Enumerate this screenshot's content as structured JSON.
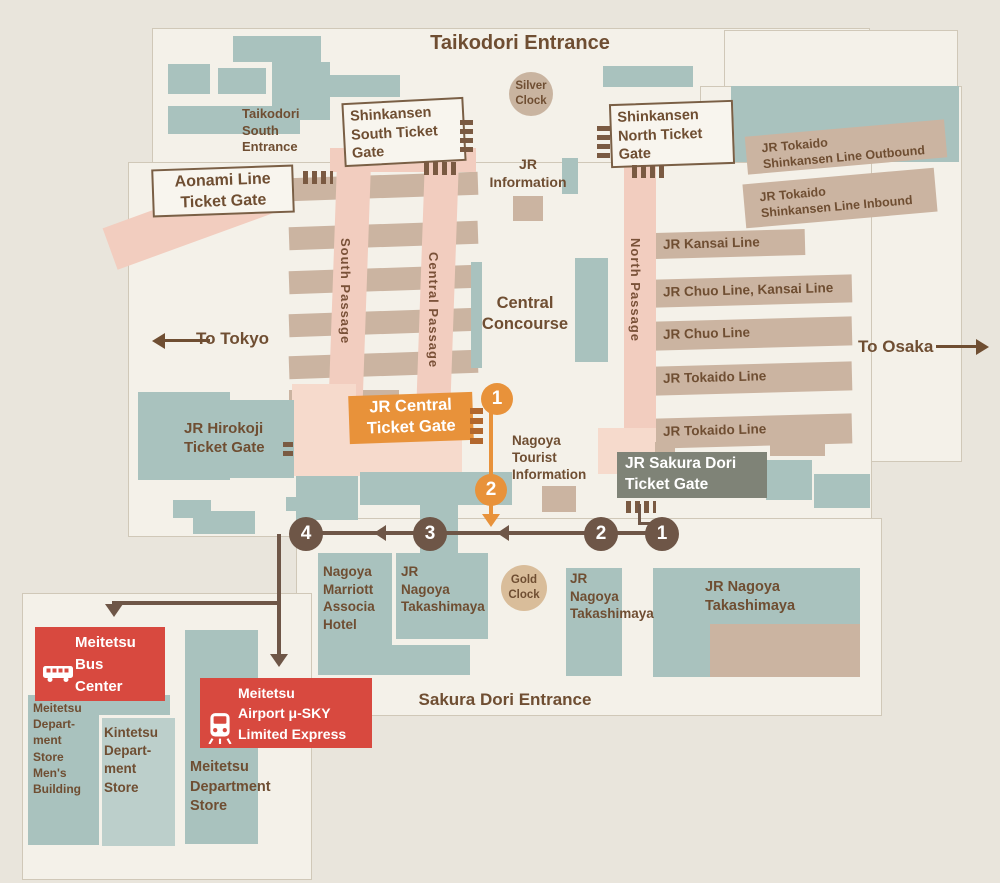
{
  "colors": {
    "background": "#E9E5DC",
    "floor": "#F4F1E9",
    "teal_block": "#A9C2BE",
    "tan_platform": "#CBB4A1",
    "pink_passage": "#F2CDBF",
    "light_pink": "#F6DACC",
    "orange_accent": "#E8923A",
    "route_brown": "#6E5647",
    "red_accent": "#D8493F",
    "olive_gate": "#7F8377",
    "text_brown": "#6F4E32"
  },
  "labels": {
    "taikodori_entrance": "Taikodori Entrance",
    "taikodori_south_entrance": "Taikodori\nSouth\nEntrance",
    "sakura_dori_entrance": "Sakura Dori Entrance",
    "silver_clock": "Silver\nClock",
    "gold_clock": "Gold\nClock",
    "jr_information": "JR\nInformation",
    "tourist_information": "Nagoya\nTourist\nInformation",
    "central_concourse": "Central\nConcourse",
    "to_tokyo": "To Tokyo",
    "to_osaka": "To Osaka"
  },
  "gates": {
    "shinkansen_south": "Shinkansen\nSouth Ticket\nGate",
    "shinkansen_north": "Shinkansen\nNorth Ticket\nGate",
    "aonami": "Aonami Line\nTicket Gate",
    "jr_central": "JR Central\nTicket Gate",
    "jr_sakura_dori": "JR Sakura Dori\nTicket Gate",
    "jr_hirokoji": "JR Hirokoji\nTicket Gate"
  },
  "passages": {
    "south": "South Passage",
    "central": "Central Passage",
    "north": "North Passage"
  },
  "rail_lines": [
    {
      "label": "JR Tokaido\nShinkansen Line Outbound"
    },
    {
      "label": "JR Tokaido\nShinkansen Line Inbound"
    },
    {
      "label": "JR Kansai Line"
    },
    {
      "label": "JR Chuo Line, Kansai Line"
    },
    {
      "label": "JR Chuo Line"
    },
    {
      "label": "JR Tokaido Line"
    },
    {
      "label": "JR Tokaido Line"
    }
  ],
  "buildings": {
    "marriott": "Nagoya\nMarriott\nAssocia\nHotel",
    "takashimaya_center_left": "JR\nNagoya\nTakashimaya",
    "takashimaya_center_right": "JR\nNagoya\nTakashimaya",
    "takashimaya_east": "JR Nagoya\nTakashimaya",
    "meitetsu_bus_center": "Meitetsu\nBus\nCenter",
    "meitetsu_airport": "Meitetsu\nAirport μ-SKY\nLimited Express",
    "meitetsu_mens": "Meitetsu\nDepart-\nment\nStore\nMen's\nBuilding",
    "kintetsu": "Kintetsu\nDepart-\nment\nStore",
    "meitetsu_dept": "Meitetsu\nDepartment\nStore"
  },
  "route_markers": {
    "orange": [
      "1",
      "2"
    ],
    "brown": [
      "4",
      "3",
      "2",
      "1"
    ]
  }
}
